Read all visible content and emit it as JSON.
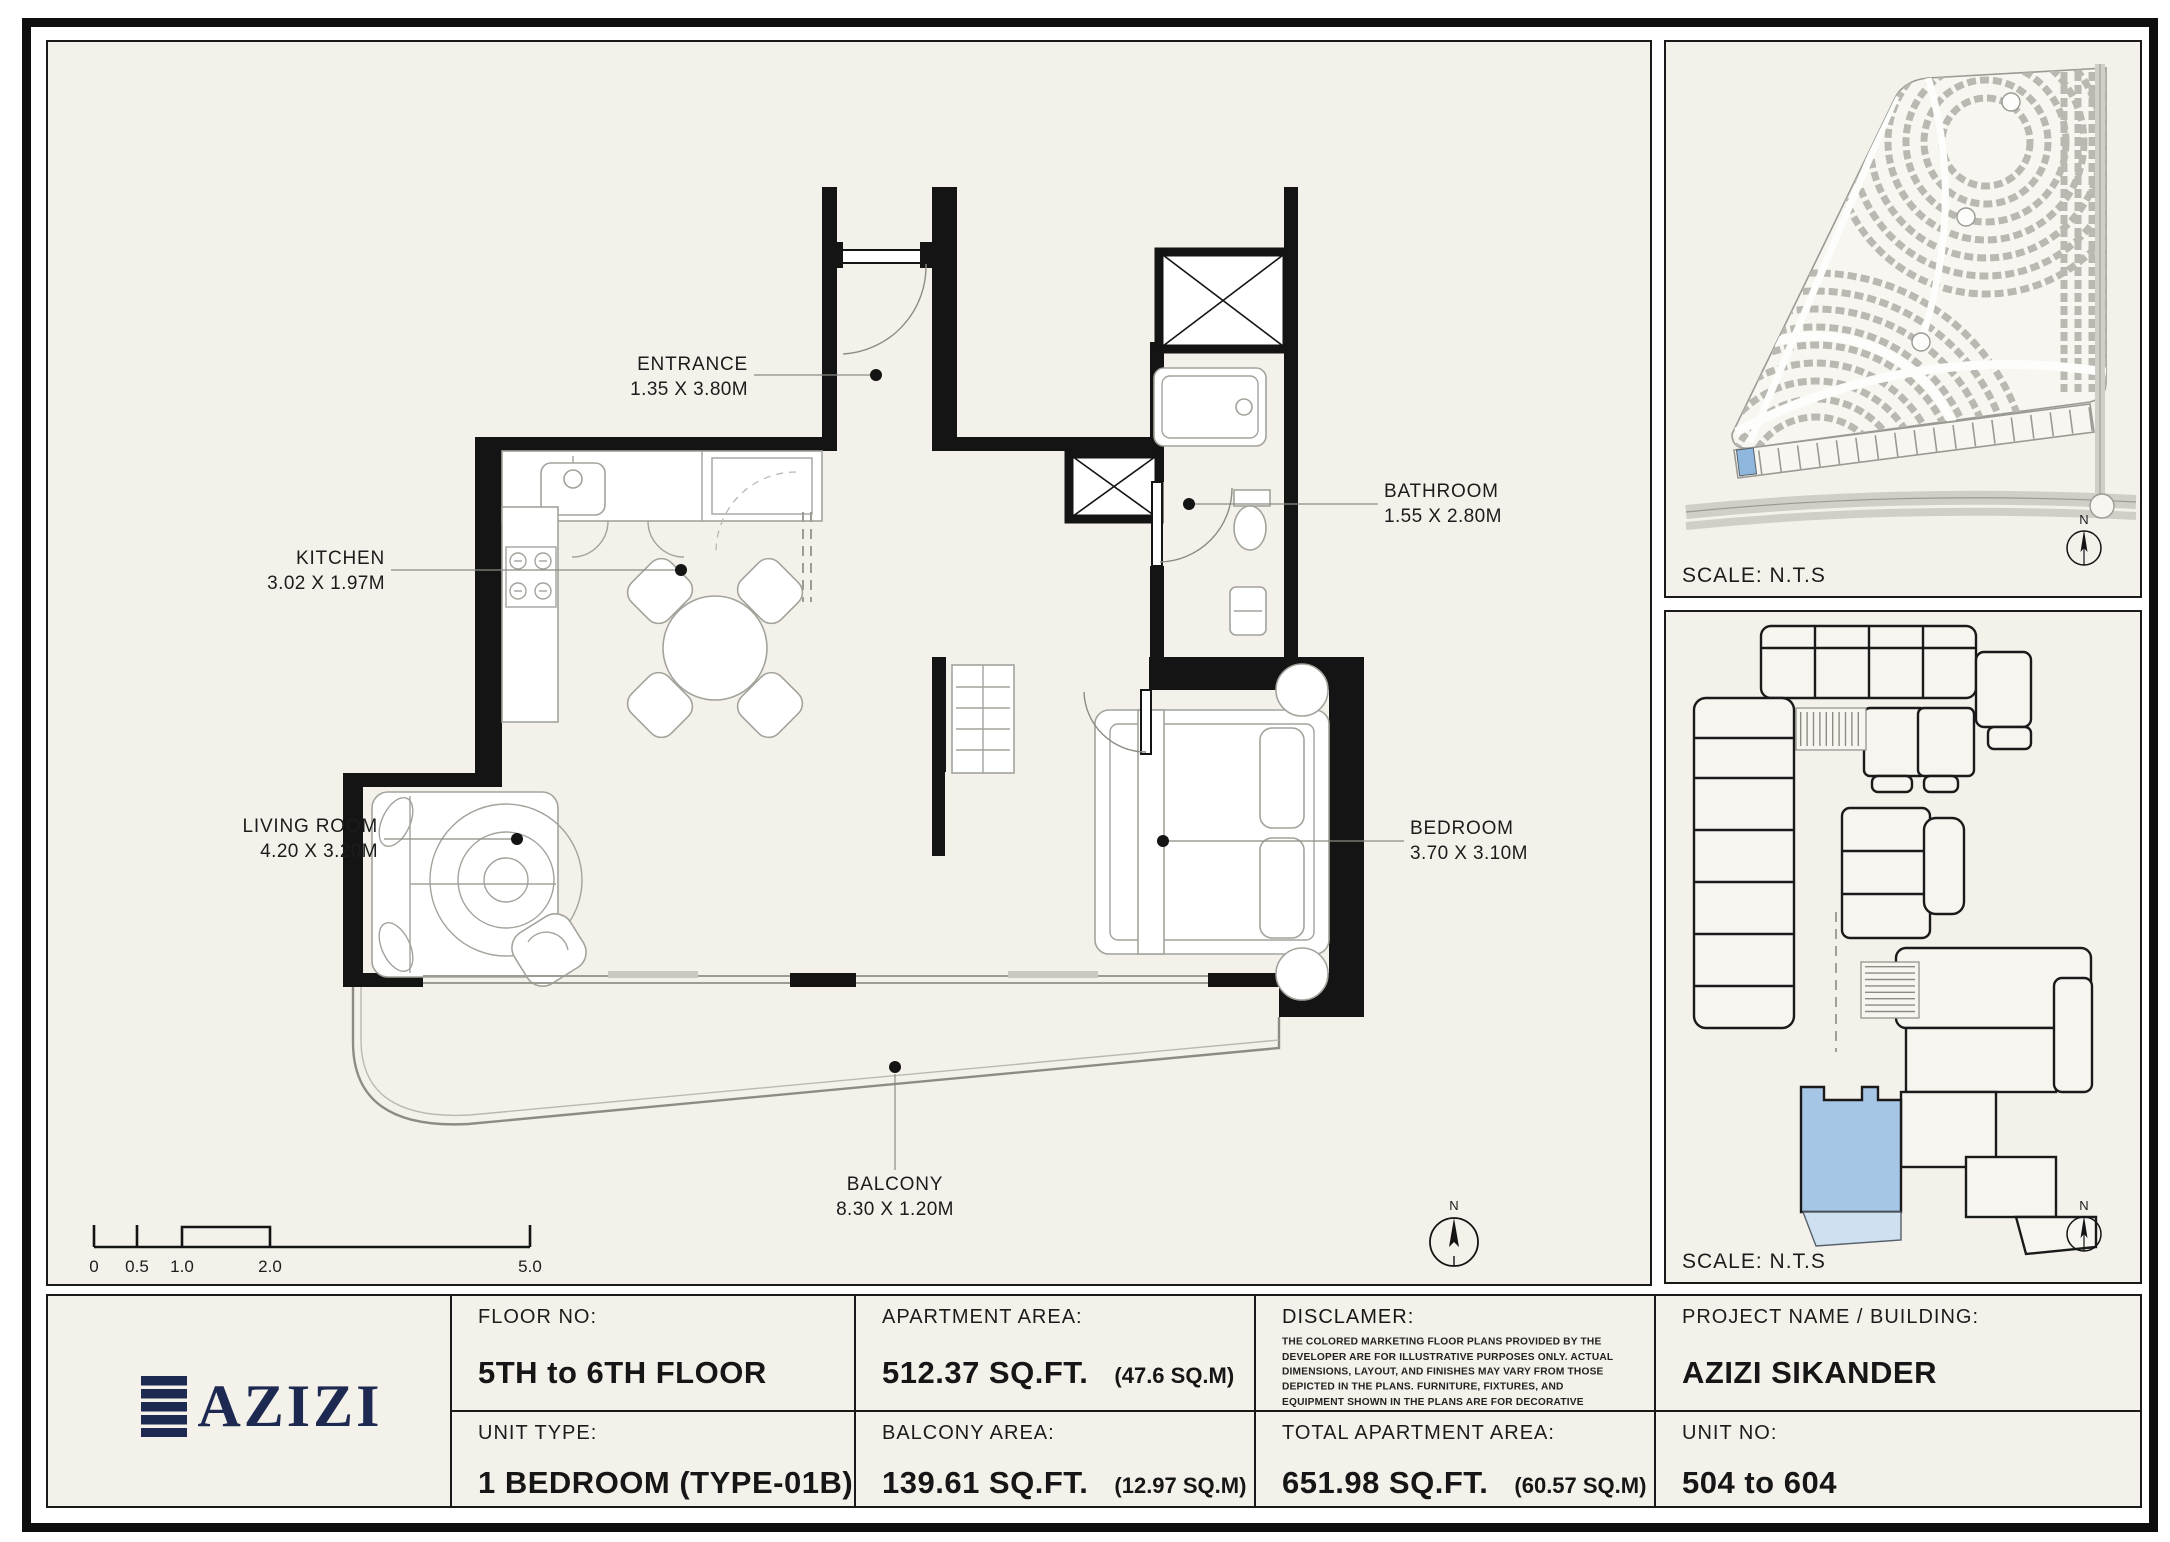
{
  "branding": {
    "logo_text": "AZIZI",
    "logo_color": "#1d2950"
  },
  "plan": {
    "rooms": {
      "entrance": {
        "name": "ENTRANCE",
        "dimensions": "1.35 X 3.80M"
      },
      "kitchen": {
        "name": "KITCHEN",
        "dimensions": "3.02 X 1.97M"
      },
      "living": {
        "name": "LIVING ROOM",
        "dimensions": "4.20 X 3.20M"
      },
      "bathroom": {
        "name": "BATHROOM",
        "dimensions": "1.55 X 2.80M"
      },
      "bedroom": {
        "name": "BEDROOM",
        "dimensions": "3.70 X 3.10M"
      },
      "balcony": {
        "name": "BALCONY",
        "dimensions": "8.30 X 1.20M"
      }
    },
    "scale_bar": {
      "t0": "0",
      "t05": "0.5",
      "t1": "1.0",
      "t2": "2.0",
      "t5": "5.0"
    },
    "north_label": "N"
  },
  "site_map": {
    "scale_label": "SCALE: N.T.S",
    "north_label": "N"
  },
  "key_plan": {
    "scale_label": "SCALE: N.T.S",
    "north_label": "N",
    "highlight_color": "#a6c6e5"
  },
  "info_table": {
    "floor_no": {
      "label": "FLOOR NO:",
      "value": "5TH to 6TH FLOOR"
    },
    "apartment_area": {
      "label": "APARTMENT AREA:",
      "value": "512.37 SQ.FT.",
      "note": "(47.6 SQ.M)"
    },
    "disclaimer": {
      "label": "DISCLAMER:",
      "body": "THE COLORED MARKETING FLOOR PLANS PROVIDED BY THE DEVELOPER ARE FOR ILLUSTRATIVE PURPOSES ONLY. ACTUAL DIMENSIONS, LAYOUT, AND FINISHES MAY VARY FROM THOSE DEPICTED IN THE PLANS. FURNITURE, FIXTURES, AND EQUIPMENT SHOWN IN THE PLANS ARE FOR DECORATIVE PURPOSES ONLY AND ARE NOT INCLUDED IN THE PURCHASE OR LEASE OF THE PROPERTY. THE DEVELOPER RESERVES THE RIGHT TO MAKE MODIFICATIONS, REVISIONS, AND CHANGES TO THE FLOOR PLANS, SPECIFICATIONS, AND FEATURES WITHOUT PRIOR NOTICE."
    },
    "project": {
      "label": "PROJECT NAME / BUILDING:",
      "value": "AZIZI SIKANDER"
    },
    "unit_type": {
      "label": "UNIT TYPE:",
      "value": "1 BEDROOM (TYPE-01B)"
    },
    "balcony_area": {
      "label": "BALCONY AREA:",
      "value": "139.61 SQ.FT.",
      "note": "(12.97 SQ.M)"
    },
    "total_area": {
      "label": "TOTAL APARTMENT AREA:",
      "value": "651.98 SQ.FT.",
      "note": "(60.57 SQ.M)"
    },
    "unit_no": {
      "label": "UNIT NO:",
      "value": "504 to 604"
    }
  }
}
